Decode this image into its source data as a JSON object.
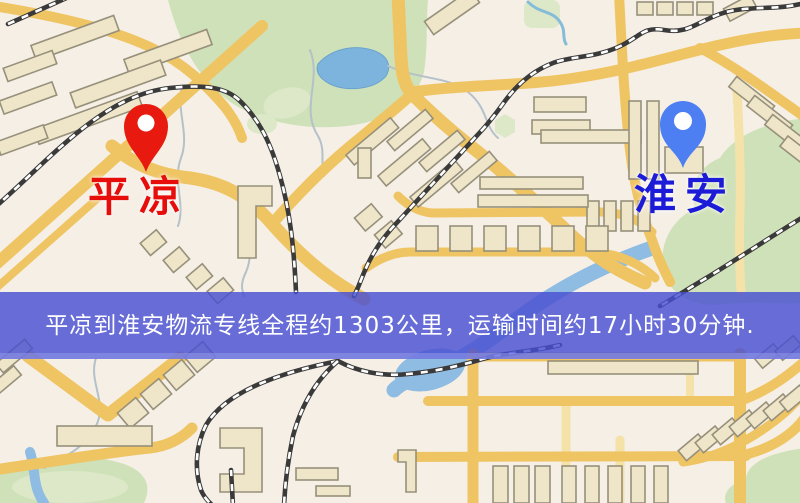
{
  "map": {
    "background_color": "#f5efe6",
    "road_color": "#efc463",
    "green_area_color": "#cfe1b8",
    "water_color": "#8fbce2",
    "railway_color": "#3a3a3a",
    "origin_marker": {
      "label": "平凉",
      "pin_color": "#e8190e",
      "label_color": "#e60d0a"
    },
    "destination_marker": {
      "label": "淮安",
      "pin_color": "#4d7ef2",
      "label_color": "#1c1cd8"
    }
  },
  "banner": {
    "text": "平凉到淮安物流专线全程约1303公里，运输时间约17小时30分钟.",
    "background_color": "#484fd2",
    "text_color": "#ffffff",
    "distance": "约1303公里",
    "duration": "约17小时30分钟"
  }
}
